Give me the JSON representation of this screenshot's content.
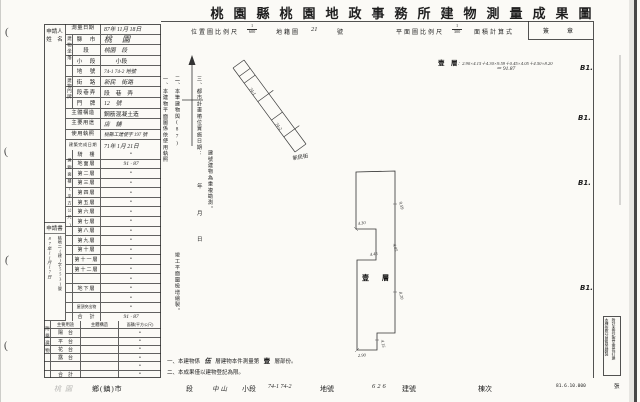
{
  "colors": {
    "paper": "#fbfaf6",
    "ink": "#1f1f1f",
    "hand_ink": "#2b2b2b"
  },
  "title": "桃園縣桃園地政事務所建物測量成果圖",
  "header": {
    "loc_scale_label": "位置圖比例尺",
    "loc_scale_num": "1",
    "loc_scale_den": "600",
    "cadastral_label": "地籍圖",
    "cadastral_value": "21",
    "cadastral_unit": "號",
    "plan_scale_label": "平面圖比例尺",
    "plan_scale_num": "1",
    "plan_scale_den": "300",
    "formula_label": "面積計算式",
    "sign_label": "簽　章",
    "formula_floor": "壹　層",
    "formula_expr": "：2.90×4.15＋4.30×9.59＋0.45×4.05＋4.50×8.20",
    "formula_result": "＝ 91.87"
  },
  "table": {
    "applicant_l1": "申請人",
    "applicant_l2": "姓　名",
    "application_label": "申請書",
    "receipt_date": "87年11月17日",
    "receipt_no": "桃地二(建)字5531號",
    "group_situs": "建物坐落",
    "group_door": "建物門牌",
    "group_area": "建物面積(平方公尺)",
    "group_attached": "附屬建物",
    "rows_top": [
      {
        "label": "測量日期",
        "value": "87年 11月 18日"
      },
      {
        "label": "縣　市",
        "value": "桃 園"
      },
      {
        "label": "段",
        "value": "桃園　段"
      },
      {
        "label": "小　段",
        "value": "　　小段"
      },
      {
        "label": "地　號",
        "value": "74-1 74-2 地號"
      },
      {
        "label": "街　路",
        "value": "新民　街路"
      },
      {
        "label": "段巷弄",
        "value": "段　巷　弄"
      },
      {
        "label": "門　牌",
        "value": "12　號"
      },
      {
        "label": "主體構造",
        "value": "鋼筋混凝土造"
      },
      {
        "label": "主要用途",
        "value": "店　舖"
      },
      {
        "label": "使用執照",
        "value": "桃縣工建使字 197 號"
      },
      {
        "label": "建築完成日期",
        "value": "71年 1月 21日"
      }
    ],
    "floor_rows": [
      {
        "label": "騎　樓",
        "value": "•"
      },
      {
        "label": "地面層",
        "value": "91 · 87"
      },
      {
        "label": "第二層",
        "value": "•"
      },
      {
        "label": "第三層",
        "value": "•"
      },
      {
        "label": "第四層",
        "value": "•"
      },
      {
        "label": "第五層",
        "value": "•"
      },
      {
        "label": "第六層",
        "value": "•"
      },
      {
        "label": "第七層",
        "value": "•"
      },
      {
        "label": "第八層",
        "value": "•"
      },
      {
        "label": "第九層",
        "value": "•"
      },
      {
        "label": "第十層",
        "value": "•"
      },
      {
        "label": "第十一層",
        "value": "•"
      },
      {
        "label": "第十二層",
        "value": "•"
      },
      {
        "label": "",
        "value": "•"
      },
      {
        "label": "地下層",
        "value": "•"
      },
      {
        "label": "",
        "value": "•"
      },
      {
        "label": "屋頂突出物",
        "value": "•"
      },
      {
        "label": "合　計",
        "value": "91 · 87"
      }
    ],
    "attached_header": {
      "use": "主要用途",
      "structure": "主體構造",
      "area": "面積(平方公尺)"
    },
    "attached_rows": [
      {
        "label": "陽　台",
        "value": "•"
      },
      {
        "label": "平　台",
        "value": "•"
      },
      {
        "label": "花　台",
        "value": "•"
      },
      {
        "label": "露　台",
        "value": "•"
      },
      {
        "label": "",
        "value": "•"
      },
      {
        "label": "合　計",
        "value": "•"
      }
    ]
  },
  "notes_mid": {
    "n1": "一、本建物平面圖係依使用執照",
    "n1b": "竣工平面圖檢增繪製。",
    "n2": "二、本筆建物與(87)",
    "n2b": "建號建物為重複勘測。",
    "n3": "三、都市計畫樁位實施日期：",
    "year": "年",
    "month": "月",
    "day": "日"
  },
  "loc_map": {
    "parcel_a": "74-1",
    "parcel_b": "74-2",
    "street": "新民街"
  },
  "plan": {
    "floor_label": "壹　層",
    "dims": {
      "right_top": "9.59",
      "left_step": "4.30",
      "notch_r": "4.05",
      "notch_a": "4.45",
      "right_low": "8.20",
      "bottom_step": "4.15",
      "bottom": "2.90"
    }
  },
  "notes_bottom": {
    "a_pre": "一、本建物係",
    "a_hand": "伍",
    "a_mid": "層建物本件測量第",
    "a_bold": "壹",
    "a_post": "層部份。",
    "b": "二、本成果僅以建物登記為限。"
  },
  "footer": {
    "hand_city": "桃園",
    "township": "鄉(鎮)市",
    "section": "段",
    "hand_subsection": "中山",
    "subsection": "小段",
    "hand_parcel": "74-1  74-2",
    "parcel": "地號",
    "hand_building": "626",
    "building": "建號",
    "unit": "棟次",
    "form_no": "81.6.10.000",
    "sheet": "張"
  },
  "margin": {
    "mark": "(",
    "b1": "B1."
  },
  "corner_note": {
    "right": "附註未登記壹至壹長打建",
    "left": "本棟依照分層負責繪製"
  }
}
